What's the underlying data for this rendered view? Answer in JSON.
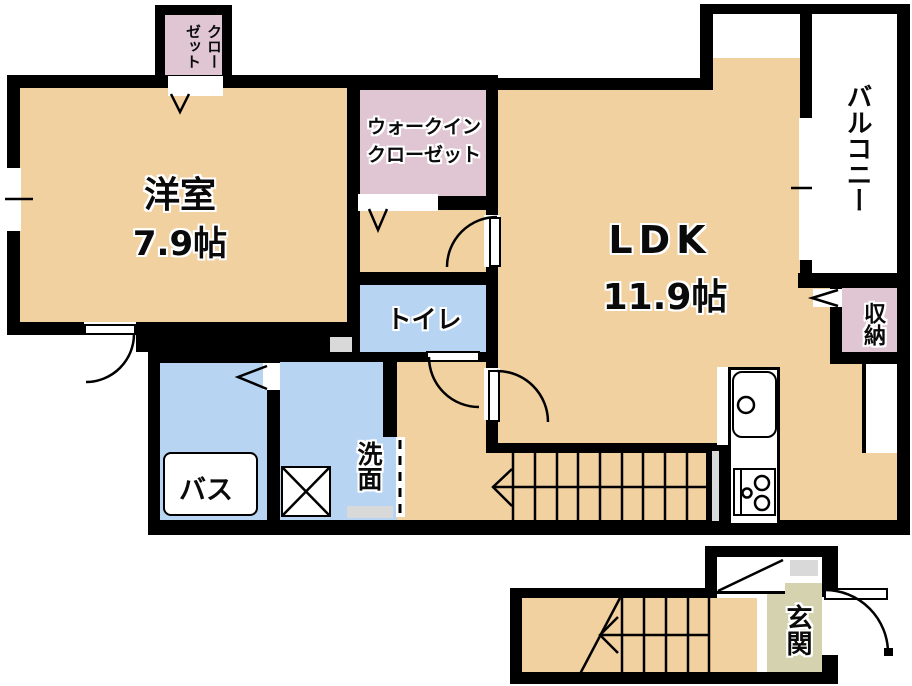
{
  "rooms": {
    "western_room": {
      "name": "洋室",
      "size": "7.9帖"
    },
    "ldk": {
      "name": "LDK",
      "size": "11.9帖"
    },
    "closet": {
      "col1": "クロー",
      "col2": "ゼット"
    },
    "walk_in_closet": {
      "line1": "ウォークイン",
      "line2": "クローゼット"
    },
    "balcony": {
      "name": "バルコニー"
    },
    "storage": {
      "name": "収納"
    },
    "toilet": {
      "name": "トイレ"
    },
    "bath": {
      "name": "バス"
    },
    "washroom": {
      "name": "洗面"
    },
    "entrance": {
      "name": "玄関"
    }
  },
  "colors": {
    "room_fill": "#F2D1A1",
    "closet_fill": "#DFC6D2",
    "wet_fill": "#B7D5F2",
    "entrance_fill": "#D5D2AF",
    "wall": "#000000",
    "fixture_gray": "#D9D9D9"
  }
}
